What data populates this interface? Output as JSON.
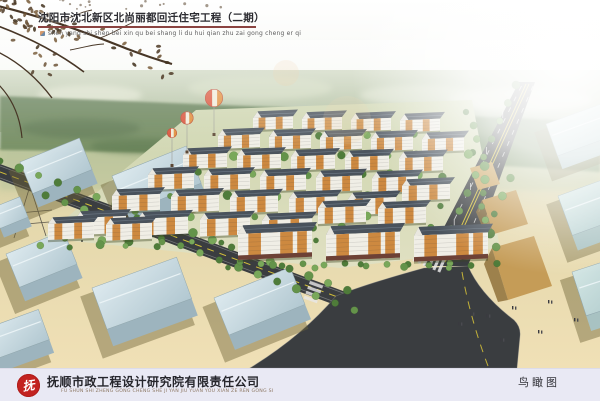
{
  "poster": {
    "title": "沈阳市沈北新区北尚丽都回迁住宅工程（二期）",
    "title_pinyin": "shen yang shi shen bei xin qu bei shang li du hui qian zhu zai gong cheng er qi",
    "company": "抚顺市政工程设计研究院有限责任公司",
    "company_pinyin": "FU SHUN SHI ZHENG GONG CHENG SHE JI YAN JIU YUAN YOU XIAN ZE REN GONG SI",
    "view_label": "鸟瞰图",
    "logo_glyph": "抚"
  },
  "colors": {
    "title_underline": "#8a4340",
    "footer_bg": "#e9e9f4",
    "logo_red": "#c32320",
    "building_roof": "#49525c",
    "facade_orange": "#cd8940",
    "facade_white": "#f0eee6",
    "warehouse_blue": "#c9dbe2",
    "road_asphalt": "#3a3d40",
    "road_line_yellow": "#d3bf39",
    "ground_tan": "#ecdcb0",
    "tree_green": "#5d8a45"
  }
}
